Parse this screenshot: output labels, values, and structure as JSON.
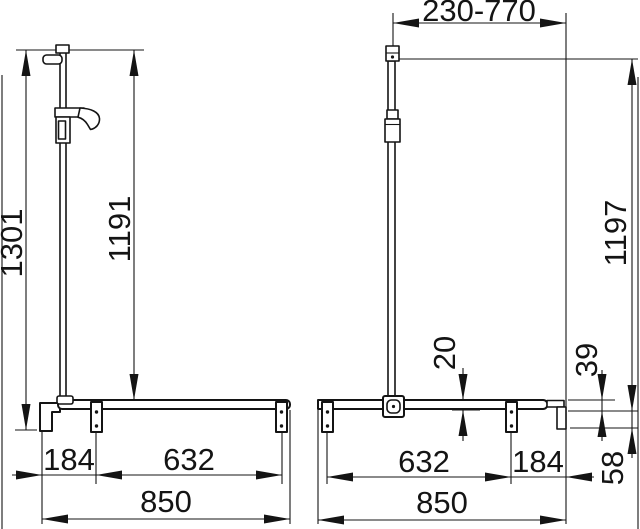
{
  "dimensions": {
    "left_view": {
      "total_height": "1301",
      "rail_height": "1191",
      "end_to_bracket": "184",
      "bracket_span": "632",
      "total_width": "850"
    },
    "right_view": {
      "slide_range": "230-770",
      "rail_height": "1197",
      "bar_diameter": "20",
      "upper_offset": "39",
      "lower_offset": "58",
      "bracket_span": "632",
      "bracket_to_end": "184",
      "total_width": "850"
    }
  },
  "colors": {
    "ink": "#141414",
    "background": "#ffffff"
  }
}
